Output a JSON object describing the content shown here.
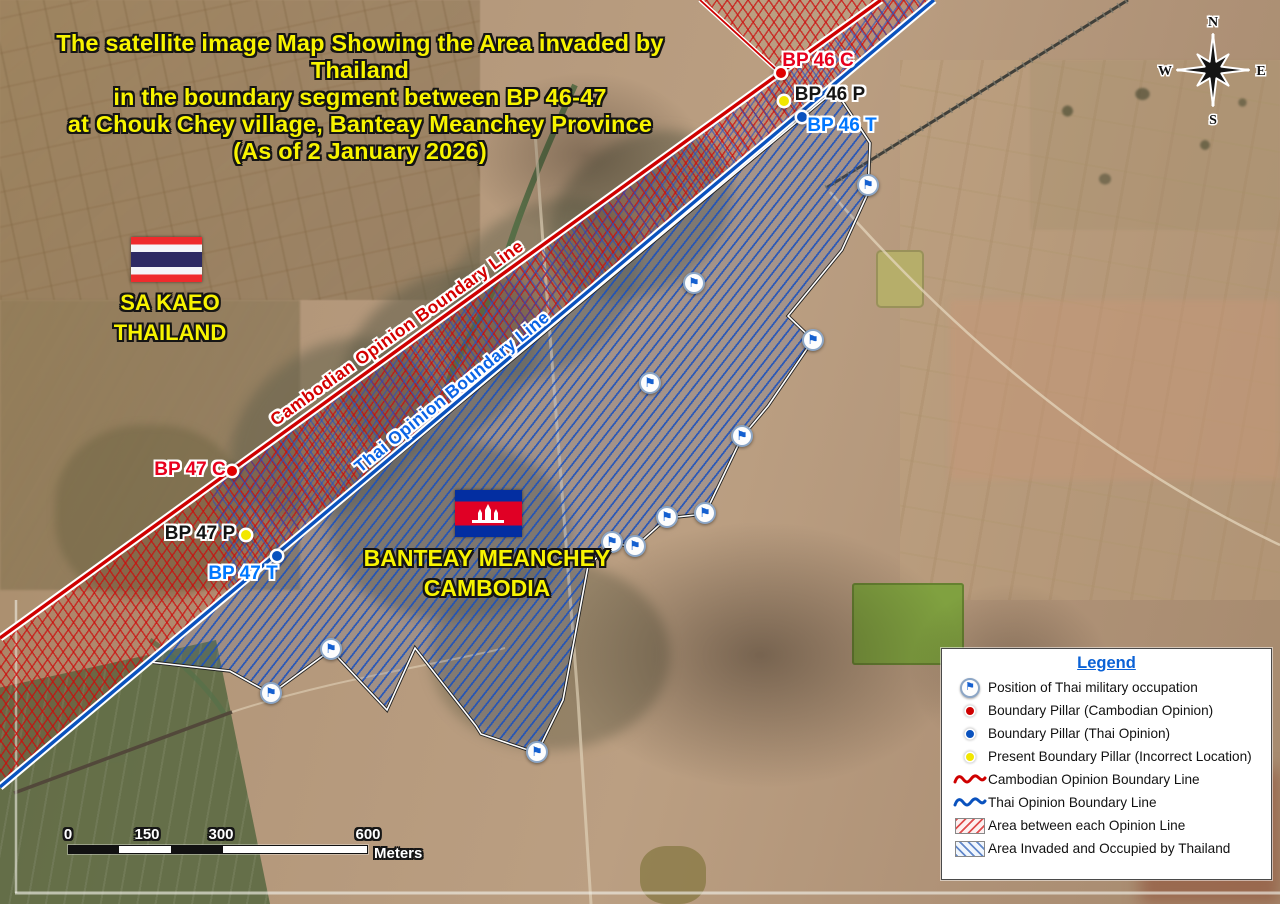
{
  "title": {
    "lines": [
      "The satellite image Map Showing the Area invaded by Thailand",
      "in the boundary segment between BP 46-47",
      "at Chouk Chey village, Banteay Meanchey Province",
      "(As of 2 January 2026)"
    ]
  },
  "compass": {
    "n": "N",
    "e": "E",
    "s": "S",
    "w": "W"
  },
  "regions": {
    "thailand": {
      "lines": [
        "SA KAEO",
        "THAILAND"
      ]
    },
    "cambodia": {
      "lines": [
        "BANTEAY MEANCHEY",
        "CAMBODIA"
      ]
    }
  },
  "boundary_lines": {
    "cambodian": {
      "label": "Cambodian Opinion Boundary Line",
      "color": "#cf0000"
    },
    "thai": {
      "label": "Thai Opinion Boundary Line",
      "color": "#0a52be"
    }
  },
  "pillars": [
    {
      "id": "bp46c",
      "label": "BP 46 C",
      "kind": "cambodian",
      "x": 781,
      "y": 73,
      "lx": 818,
      "ly": 61
    },
    {
      "id": "bp46p",
      "label": "BP 46 P",
      "kind": "present",
      "x": 784,
      "y": 101,
      "lx": 830,
      "ly": 95
    },
    {
      "id": "bp46t",
      "label": "BP 46 T",
      "kind": "thai",
      "x": 802,
      "y": 117,
      "lx": 842,
      "ly": 126
    },
    {
      "id": "bp47c",
      "label": "BP 47 C",
      "kind": "cambodian",
      "x": 232,
      "y": 471,
      "lx": 190,
      "ly": 470
    },
    {
      "id": "bp47p",
      "label": "BP 47 P",
      "kind": "present",
      "x": 246,
      "y": 535,
      "lx": 200,
      "ly": 534
    },
    {
      "id": "bp47t",
      "label": "BP 47 T",
      "kind": "thai",
      "x": 277,
      "y": 556,
      "lx": 243,
      "ly": 574
    }
  ],
  "occupation_flags": [
    {
      "x": 868,
      "y": 185
    },
    {
      "x": 694,
      "y": 283
    },
    {
      "x": 813,
      "y": 340
    },
    {
      "x": 650,
      "y": 383
    },
    {
      "x": 742,
      "y": 436
    },
    {
      "x": 705,
      "y": 513
    },
    {
      "x": 667,
      "y": 517
    },
    {
      "x": 612,
      "y": 542
    },
    {
      "x": 635,
      "y": 546
    },
    {
      "x": 331,
      "y": 649
    },
    {
      "x": 271,
      "y": 693
    },
    {
      "x": 537,
      "y": 752
    }
  ],
  "legend": {
    "title": "Legend",
    "items": [
      {
        "icon": "flag",
        "label": "Position of Thai military occupation"
      },
      {
        "icon": "pillar-cambodian",
        "label": "Boundary Pillar (Cambodian Opinion)"
      },
      {
        "icon": "pillar-thai",
        "label": "Boundary Pillar (Thai Opinion)"
      },
      {
        "icon": "pillar-present",
        "label": "Present Boundary Pillar (Incorrect Location)"
      },
      {
        "icon": "line-cambodian",
        "label": "Cambodian Opinion Boundary Line"
      },
      {
        "icon": "line-thai",
        "label": "Thai Opinion Boundary Line"
      },
      {
        "icon": "area-between",
        "label": "Area between each Opinion Line"
      },
      {
        "icon": "area-invaded",
        "label": "Area Invaded and Occupied by Thailand"
      }
    ]
  },
  "scalebar": {
    "ticks": [
      "0",
      "150",
      "300",
      "600"
    ],
    "unit": "Meters"
  },
  "icons": {
    "flag_glyph": "⚑"
  },
  "colors": {
    "title_yellow": "#f8f400",
    "cambodian_red": "#cf0000",
    "thai_blue": "#0a52be",
    "present_yellow": "#f2e700",
    "legend_title_blue": "#0b62d6",
    "flag_marker_blue": "#1560d0"
  }
}
